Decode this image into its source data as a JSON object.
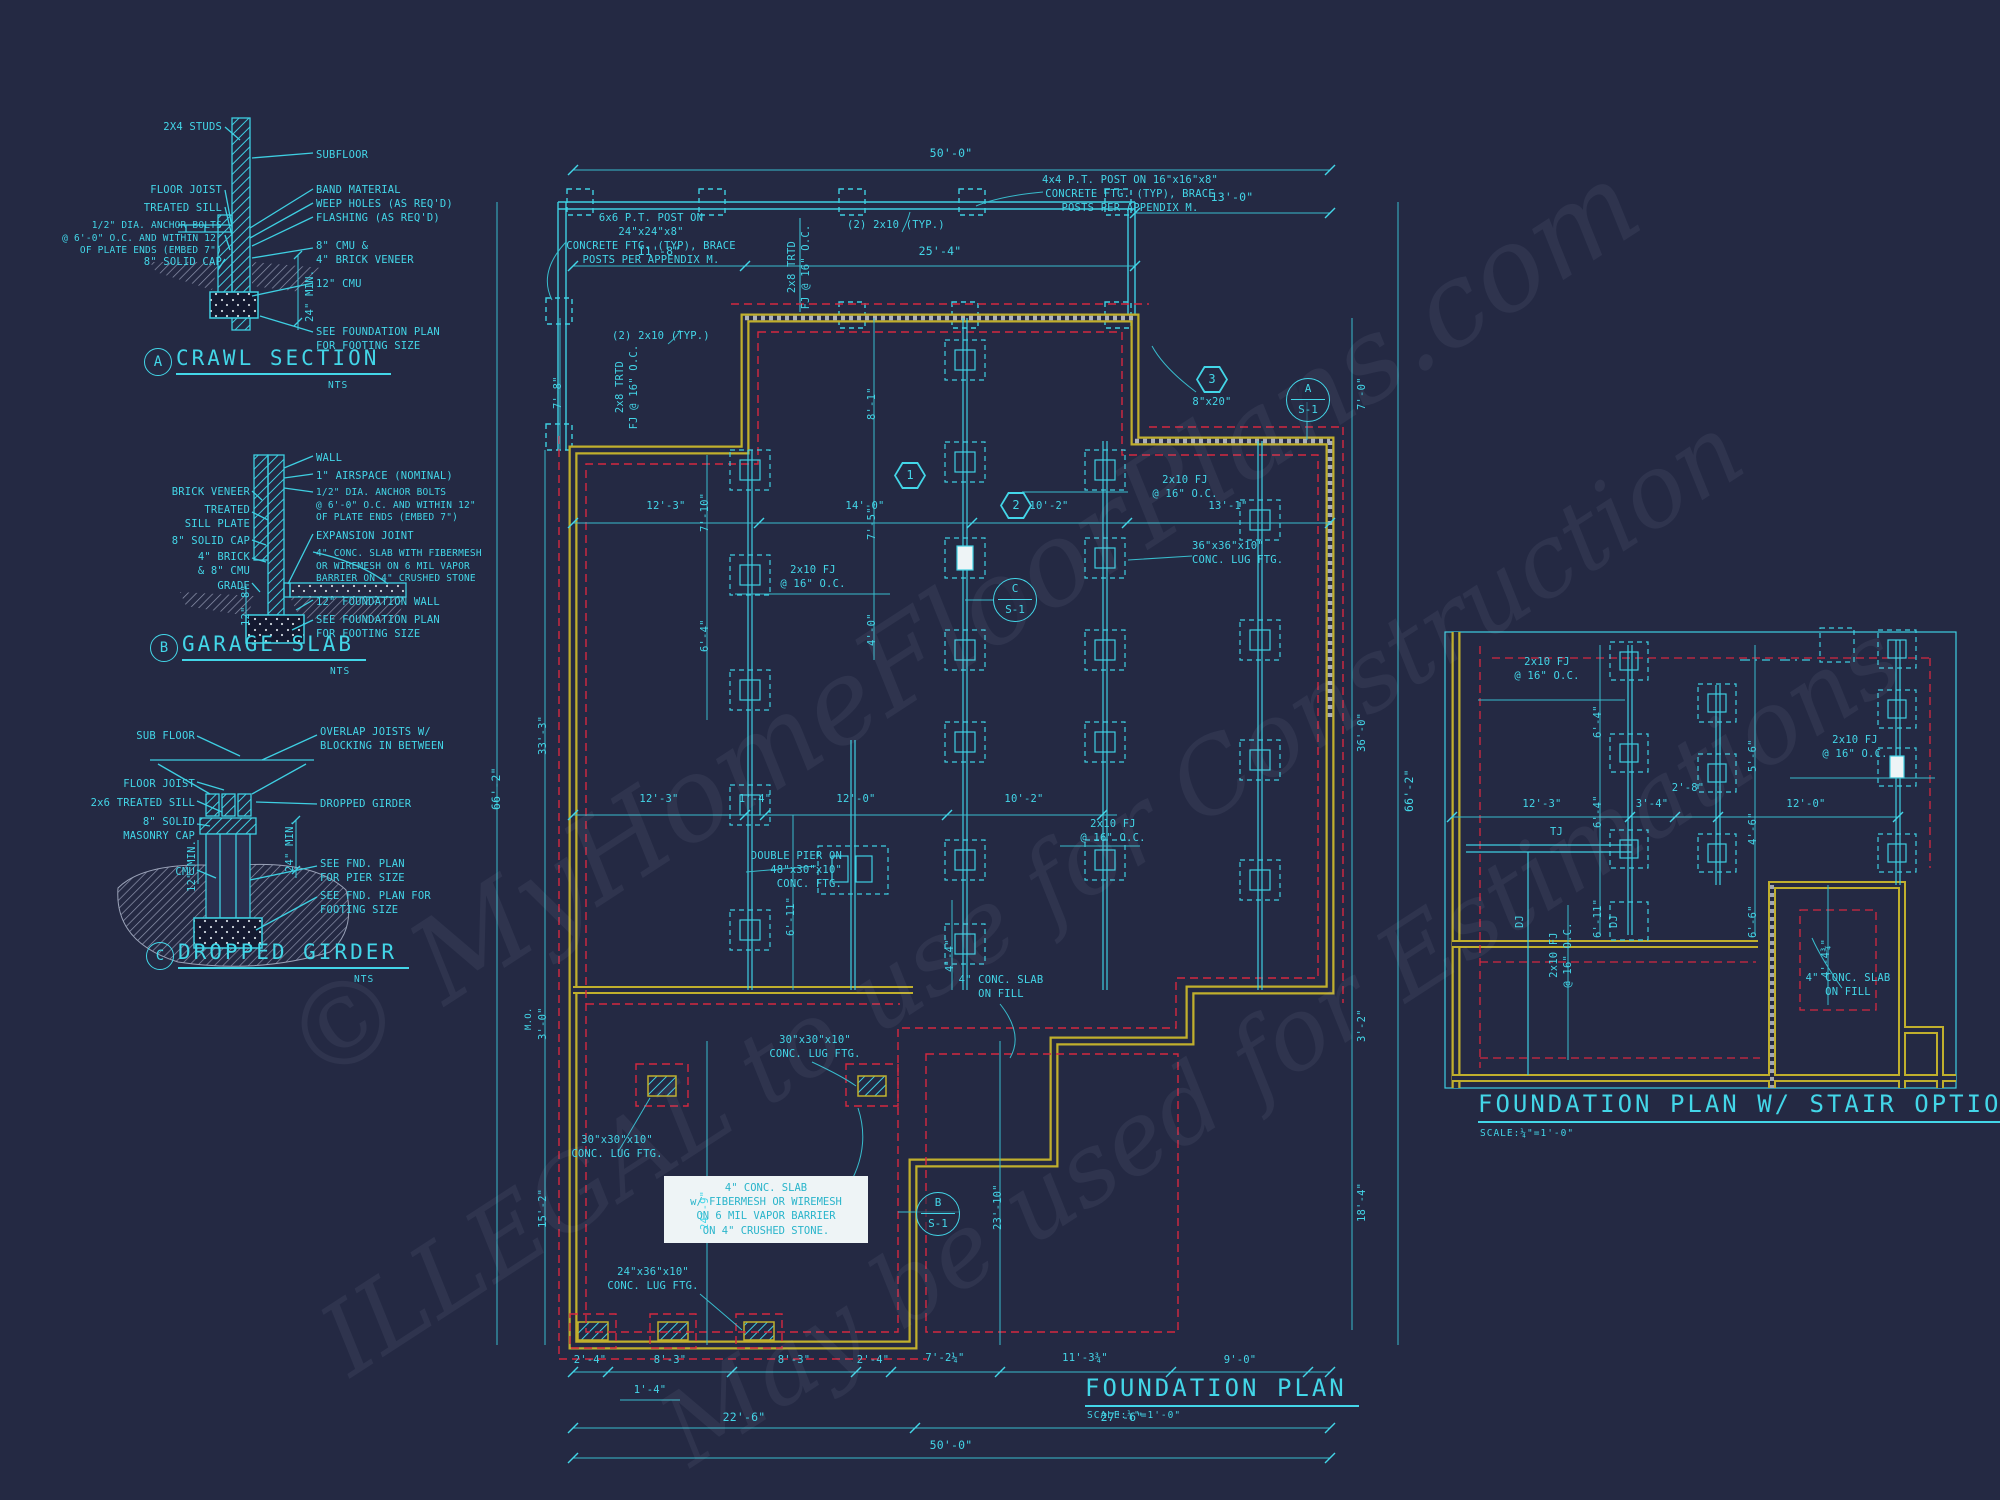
{
  "watermark": {
    "line1": "© MyHomeFloorPlans.com",
    "line2": "ILLEGAL to use for Construction",
    "line3": "May be used for Estimations"
  },
  "colors": {
    "cyan": "#43d6e8",
    "wall_yellow": "#c0af2d",
    "footing_red": "#d42840",
    "background": "#242943"
  },
  "details": {
    "crawl": {
      "marker": "A",
      "title": "CRAWL SECTION",
      "scale": "NTS",
      "labels": {
        "studs": "2X4 STUDS",
        "floor_joist": "FLOOR JOIST",
        "treated_sill": "TREATED SILL",
        "anchor_bolts": "1/2\" DIA. ANCHOR BOLTS\n@ 6'-0\" O.C. AND WITHIN 12\"\nOF PLATE ENDS (EMBED 7\")",
        "solid_cap": "8\" SOLID CAP",
        "subfloor": "SUBFLOOR",
        "band": "BAND MATERIAL",
        "weep": "WEEP HOLES (AS REQ'D)",
        "flashing": "FLASHING (AS REQ'D)",
        "cmu_brick": "8\" CMU &\n4\" BRICK VENEER",
        "cmu12": "12\" CMU",
        "see_fnd": "SEE FOUNDATION PLAN\nFOR FOOTING SIZE",
        "min24": "24\" MIN."
      }
    },
    "garage": {
      "marker": "B",
      "title": "GARAGE SLAB",
      "scale": "NTS",
      "labels": {
        "brick_veneer": "BRICK VENEER",
        "sill_plate": "TREATED\nSILL PLATE",
        "solid_cap": "8\" SOLID CAP",
        "brick_cmu": "4\" BRICK\n& 8\" CMU",
        "grade": "GRADE",
        "wall": "WALL",
        "airspace": "1\" AIRSPACE (NOMINAL)",
        "anchor_bolts": "1/2\" DIA. ANCHOR BOLTS\n@ 6'-0\" O.C. AND WITHIN 12\"\nOF PLATE ENDS (EMBED 7\")",
        "expansion": "EXPANSION JOINT",
        "slab": "4\" CONC. SLAB WITH FIBERMESH\nOR WIREMESH ON 6 MIL VAPOR\nBARRIER ON 4\" CRUSHED STONE",
        "fnd_wall": "12\" FOUNDATION WALL",
        "see_fnd": "SEE FOUNDATION PLAN\nFOR FOOTING SIZE",
        "dim8": "8\"",
        "dim12": "12\""
      }
    },
    "girder": {
      "marker": "C",
      "title": "DROPPED GIRDER",
      "scale": "NTS",
      "labels": {
        "sub_floor": "SUB FLOOR",
        "floor_joist": "FLOOR JOIST",
        "treated_sill": "2x6 TREATED SILL",
        "masonry_cap": "8\" SOLID\nMASONRY CAP",
        "cmu": "CMU",
        "overlap": "OVERLAP JOISTS W/\nBLOCKING IN BETWEEN",
        "dropped_girder": "DROPPED GIRDER",
        "pier_size": "SEE FND. PLAN\nFOR PIER SIZE",
        "footing_size": "SEE FND. PLAN FOR\nFOOTING SIZE",
        "min12": "12\" MIN.",
        "min24": "24\" MIN."
      }
    }
  },
  "main_plan": {
    "title": "FOUNDATION PLAN",
    "scale": "SCALE:¼\"=1'-0\"",
    "notes": {
      "post_6x6": "6x6 P.T. POST ON 24\"x24\"x8\"\nCONCRETE FTG. (TYP), BRACE\nPOSTS PER APPENDIX M.",
      "post_4x4": "4x4 P.T. POST ON 16\"x16\"x8\"\nCONCRETE FTG. (TYP), BRACE\nPOSTS PER APPENDIX M.",
      "ply_2x10": "(2) 2x10 (TYP.)",
      "trtd": "2x8 TRTD\nFJ @ 16\" O.C.",
      "fj": "2x10 FJ\n@ 16\" O.C.",
      "lug36": "36\"x36\"x10\"\nCONC. LUG FTG.",
      "double_pier": "DOUBLE PIER ON\n48\"x30\"x10\"\nCONC. FTG.",
      "lug30": "30\"x30\"x10\"\nCONC. LUG FTG.",
      "lug24": "24\"x36\"x10\"\nCONC. LUG FTG.",
      "slab_fill": "4\" CONC. SLAB\nON FILL",
      "slab_spec": "4\" CONC. SLAB\nw/ FIBERMESH OR WIREMESH\nON 6 MIL VAPOR BARRIER\nON 4\" CRUSHED STONE.",
      "mo": "M.O."
    },
    "markers": {
      "a": "A",
      "b": "B",
      "c": "C",
      "s1": "S-1",
      "hex1": "1",
      "hex2": "2",
      "hex3": "3",
      "hex3_label": "8\"x20\""
    },
    "dims": {
      "top_overall": "50'-0\"",
      "top_left": "11'-8\"",
      "top_mid": "25'-4\"",
      "top_right": "13'-0\"",
      "row1": [
        "12'-3\"",
        "14'-0\"",
        "10'-2\"",
        "13'-1\""
      ],
      "row2": [
        "12'-3\"",
        "1'-4\"",
        "12'-0\"",
        "10'-2\""
      ],
      "left": [
        "7'-8\"",
        "33'-3\"",
        "3'-0\"",
        "15'-2\""
      ],
      "left_overall": "66'-2\"",
      "right": [
        "7'-0\"",
        "36'-0\"",
        "3'-2\"",
        "18'-4\""
      ],
      "right_overall": "66'-2\"",
      "v1": "7'-10\"",
      "v2": "6'-4\"",
      "v3": "8'-1\"",
      "v4": "7'-5\"",
      "v5": "4'-0\"",
      "v6": "6'-11\"",
      "v7": "4'-4\"",
      "v8": "24'-9\"",
      "v9": "23'-10\"",
      "bottom_row1": [
        "2'-4\"",
        "8'-3\"",
        "8'-3\"",
        "2'-4\"",
        "7'-2¼\"",
        "11'-3¾\"",
        "9'-0\""
      ],
      "bottom_small": "1'-4\"",
      "bottom_row2": [
        "22'-6\"",
        "27'-6\""
      ],
      "bottom_overall": "50'-0\""
    }
  },
  "stair_plan": {
    "title": "FOUNDATION PLAN W/ STAIR OPTION",
    "scale": "SCALE:¼\"=1'-0\"",
    "labels": {
      "fj": "2x10 FJ\n@ 16\" O.C.",
      "tj": "TJ",
      "dj": "DJ",
      "slab_fill": "4\" CONC. SLAB\nON FILL"
    },
    "dims": {
      "row": [
        "12'-3\"",
        "3'-4\"",
        "2'-8\"",
        "12'-0\""
      ],
      "col_a": [
        "6'-4\"",
        "6'-4\"",
        "6'-11\""
      ],
      "col_b": [
        "5'-6\"",
        "4'-6\"",
        "6'-6\""
      ],
      "stair": "4'-4¾\""
    }
  }
}
